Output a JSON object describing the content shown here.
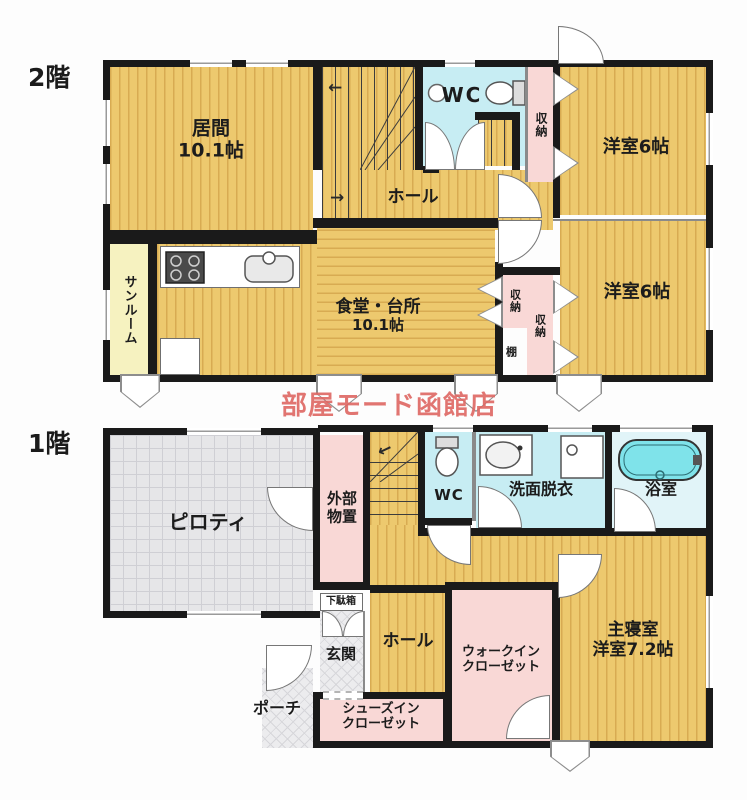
{
  "palette": {
    "wood": "#edc96e",
    "wood_stripe": "#d8ab52",
    "closet_pink": "#f9d8d6",
    "sanitary_blue": "#c7edf3",
    "bathtub_cyan": "#7fe3ea",
    "sunroom_yellow": "#f6f2c0",
    "wall_black": "#1a1a1a",
    "watermark_red": "#de6662"
  },
  "watermark": "部屋モード函館店",
  "f2": {
    "floor_label": "2階",
    "living_name": "居間",
    "living_size": "10.1帖",
    "hall": "ホール",
    "wc": "WC",
    "closet_top": "収納",
    "room_top": "洋室6帖",
    "sunroom": "サンルーム",
    "dining_name": "食堂・台所",
    "dining_size": "10.1帖",
    "closet_a": "収納",
    "closet_b": "収納",
    "shelf": "棚",
    "room_bottom": "洋室6帖"
  },
  "f1": {
    "floor_label": "1階",
    "piloti": "ピロティ",
    "storage_line1": "外部",
    "storage_line2": "物置",
    "wc": "WC",
    "washroom": "洗面脱衣",
    "bath": "浴室",
    "shoe_cabinet": "下駄箱",
    "entrance": "玄関",
    "hall": "ホール",
    "wic_line1": "ウォークイン",
    "wic_line2": "クローゼット",
    "master_line1": "主寝室",
    "master_line2": "洋室7.2帖",
    "porch": "ポーチ",
    "sic_line1": "シューズイン",
    "sic_line2": "クローゼット"
  }
}
